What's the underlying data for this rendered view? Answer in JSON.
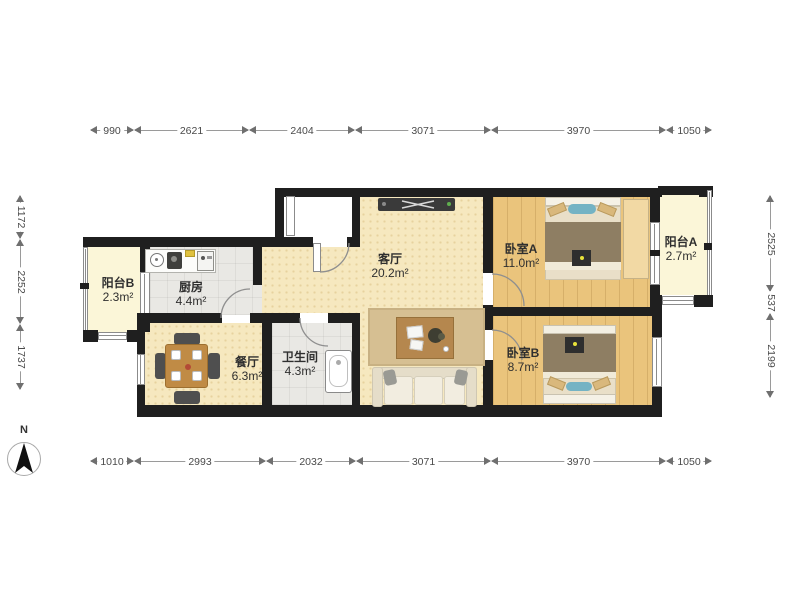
{
  "compass": {
    "label": "N"
  },
  "rooms": [
    {
      "name": "阳台B",
      "area": "2.3m²"
    },
    {
      "name": "厨房",
      "area": "4.4m²"
    },
    {
      "name": "餐厅",
      "area": "6.3m²"
    },
    {
      "name": "卫生间",
      "area": "4.3m²"
    },
    {
      "name": "客厅",
      "area": "20.2m²"
    },
    {
      "name": "卧室A",
      "area": "11.0m²"
    },
    {
      "name": "阳台A",
      "area": "2.7m²"
    },
    {
      "name": "卧室B",
      "area": "8.7m²"
    }
  ],
  "dimensions": {
    "top": [
      "990",
      "2621",
      "2404",
      "3071",
      "3970",
      "1050"
    ],
    "bottom": [
      "1010",
      "2993",
      "2032",
      "3071",
      "3970",
      "1050"
    ],
    "left": [
      "1172",
      "2252",
      "1737"
    ],
    "right": [
      "2525",
      "537",
      "2199"
    ]
  },
  "colors": {
    "wall": "#1f1f1f",
    "floor_wood": "#eac47c",
    "floor_living": "#f6e8bf",
    "floor_balcony": "#fbf6d8",
    "floor_tile": "#e9e8e4",
    "dimension_text": "#4a4a4a"
  }
}
